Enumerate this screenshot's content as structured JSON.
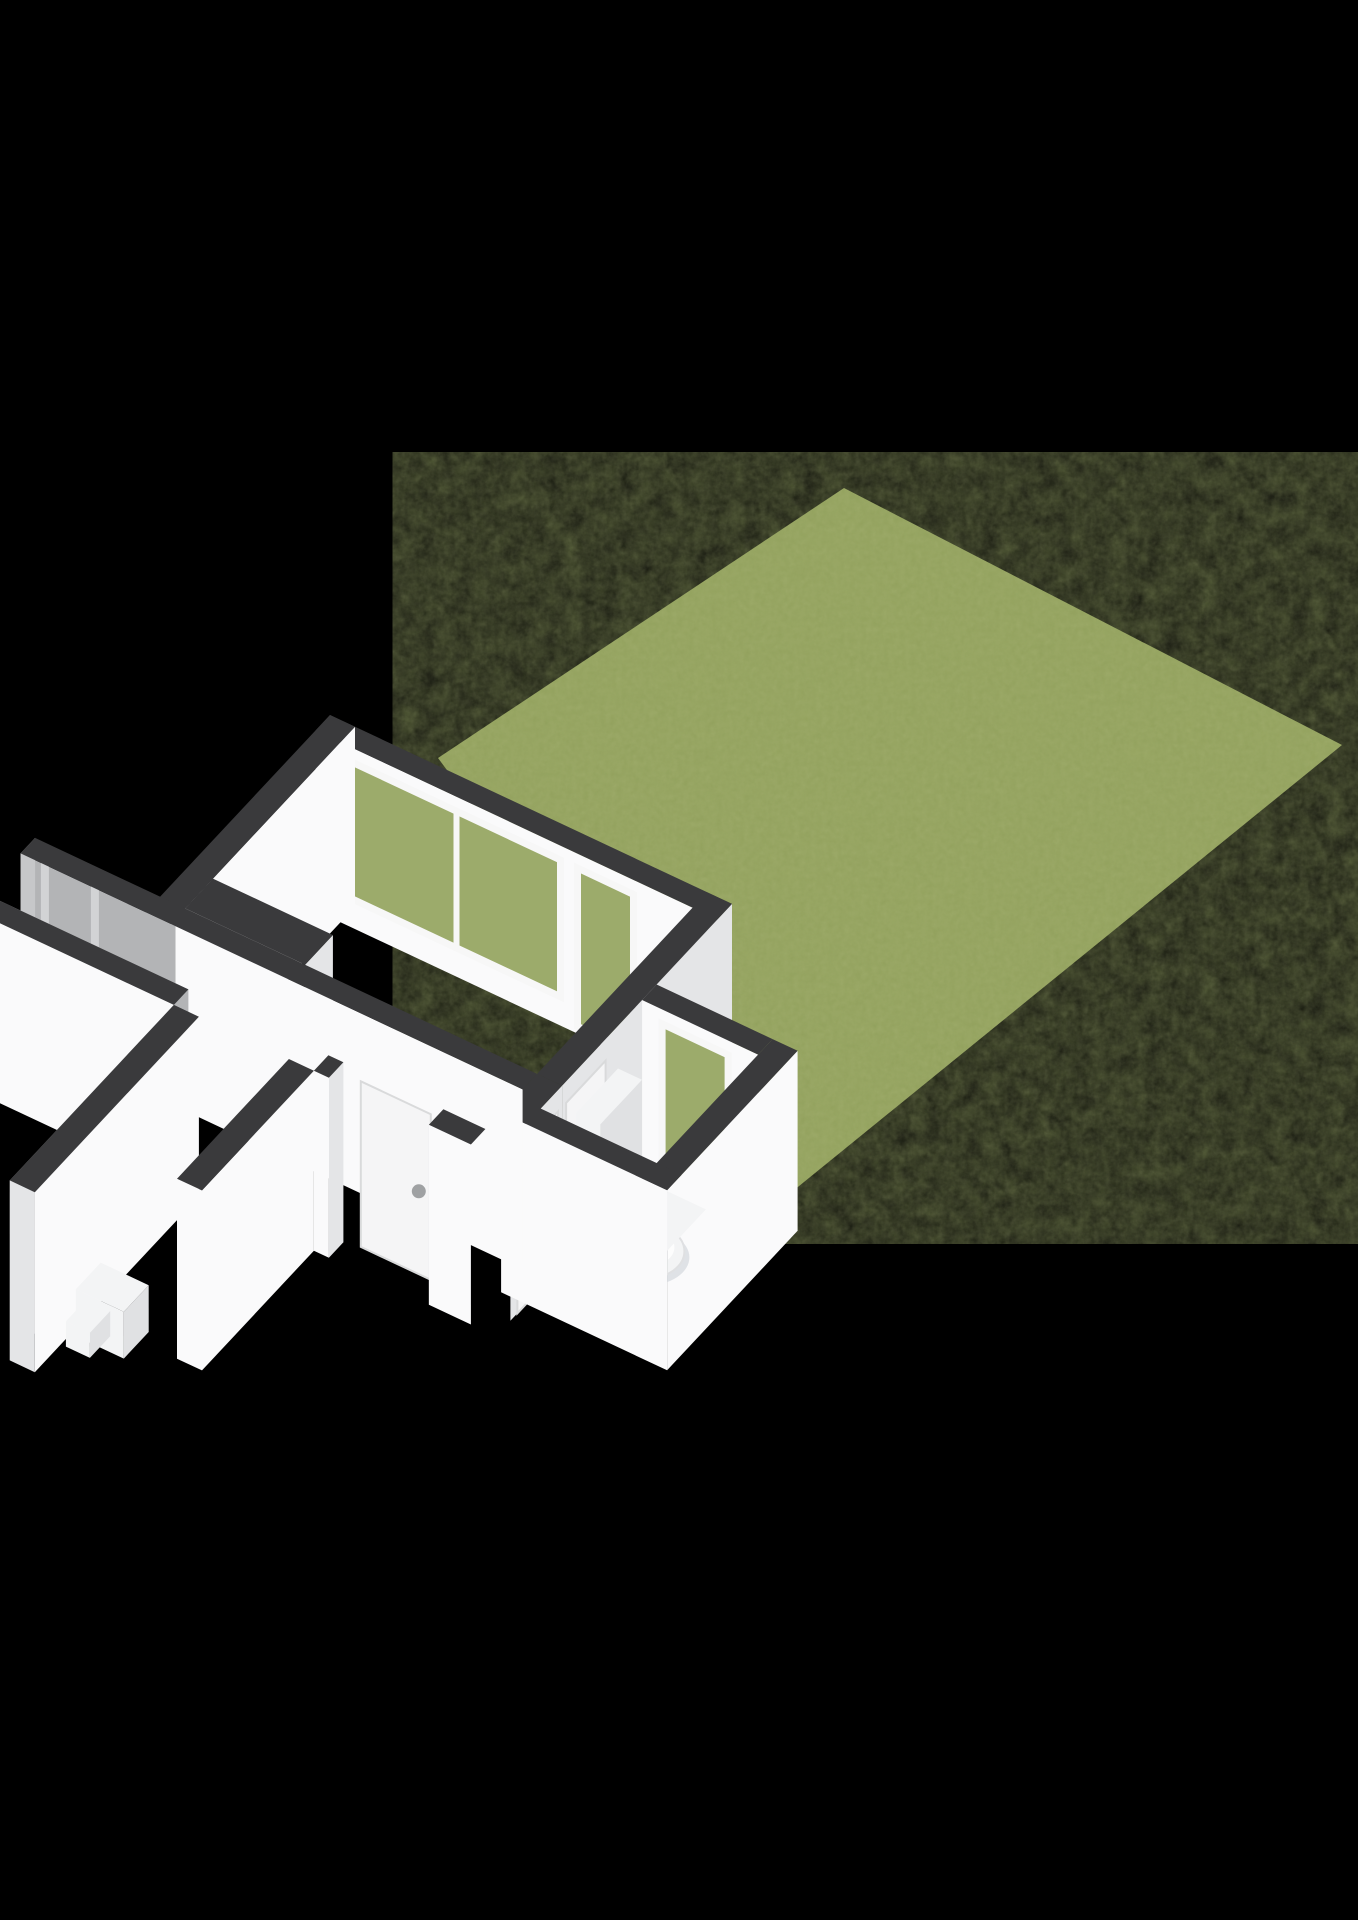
{
  "image": {
    "kind": "3d-floorplan-render",
    "background": "#000000",
    "canvas": {
      "width": 1358,
      "height": 1920
    }
  },
  "projection": {
    "ox": 330,
    "oyCap": 715,
    "ax": 100,
    "ay": 47,
    "bx": -58,
    "by": 62,
    "wallHeight": 180
  },
  "colors": {
    "bg": "#000000",
    "cap": "#3a3a3c",
    "wallBright": "#fafafb",
    "wallLight": "#f1f2f3",
    "wallMid": "#e4e5e7",
    "wallShade": "#d2d3d5",
    "wallGray": "#b3b4b6",
    "wallCut": "#c6c7c9",
    "floorTan": "#d7b07b",
    "floorBath": "#c9d2de",
    "floorHall": "#f2f3f4",
    "grassBase": "#93a25d",
    "glass": "#9cab6b",
    "frame": "#f7f7f7",
    "door": "#f5f5f6",
    "handle": "#9fa1a3",
    "fixture": "#f3f4f5",
    "fixtureShade": "#e0e1e3",
    "toiletShadow": "#c9cdd6"
  },
  "primitives": [
    {
      "t": "screen",
      "n": "garden-lawn",
      "fill": "grassBase",
      "tex": true,
      "pts": [
        [
          844,
          488
        ],
        [
          1342,
          745
        ],
        [
          772,
          1208
        ],
        [
          438,
          758
        ]
      ]
    },
    {
      "t": "face",
      "n": "living-room-garden-wall",
      "side": "sw",
      "v": 0.25,
      "u1": 0,
      "u2": 4.02,
      "fill": "wallBright"
    },
    {
      "t": "glass",
      "n": "living-room-window",
      "v": 0.25,
      "u1": 0.35,
      "u2": 2.45,
      "ft": 0.92,
      "fb": 0.16,
      "mull": [
        1.38
      ]
    },
    {
      "t": "glass",
      "n": "living-room-tall-window",
      "v": 0.25,
      "u1": 2.62,
      "u2": 3.18,
      "ft": 0.92,
      "fb": 0.04,
      "mull": []
    },
    {
      "t": "cap",
      "n": "living-room-garden-wall-cap",
      "u1": 0,
      "v1": 0,
      "u2": 4.02,
      "v2": 0.25
    },
    {
      "t": "face",
      "n": "living-room-west-wall",
      "side": "se",
      "u": 0.25,
      "v1": 0,
      "v2": 3.18,
      "fill": "wallBright"
    },
    {
      "t": "face",
      "n": "living-room-west-wall-end",
      "side": "sw",
      "v": 3.18,
      "u1": 0,
      "u2": 0.25,
      "fill": "wallCut"
    },
    {
      "t": "cap",
      "n": "living-room-west-wall-cap",
      "u1": 0,
      "v1": 0,
      "u2": 0.25,
      "v2": 3.18
    },
    {
      "t": "floor",
      "n": "living-room-floor",
      "fill": "floorTan",
      "pts": [
        [
          0.25,
          0.25
        ],
        [
          3.77,
          0.25
        ],
        [
          3.77,
          2.93
        ],
        [
          1.45,
          2.93
        ],
        [
          1.45,
          2.45
        ],
        [
          0.25,
          2.45
        ]
      ]
    },
    {
      "t": "wall",
      "n": "closet-block",
      "u1": 0.25,
      "v1": 2.45,
      "u2": 1.45,
      "v2": 2.93,
      "faces": [
        {
          "s": "se",
          "fill": "wallMid"
        }
      ]
    },
    {
      "t": "face",
      "n": "living-hall-divider-face",
      "side": "se",
      "u": 4.02,
      "v1": 0,
      "v2": 2.93,
      "fill": "wallMid"
    },
    {
      "t": "cap",
      "n": "living-hall-divider-cap",
      "u1": 3.77,
      "v1": 0,
      "u2": 4.02,
      "v2": 2.93
    },
    {
      "t": "door",
      "n": "living-room-door",
      "u": 4.02,
      "v1": 2.18,
      "v2": 2.86,
      "ft": 0.88,
      "handle": [
        2.74,
        0.46
      ]
    },
    {
      "t": "face",
      "n": "hall-bath-divider-face",
      "side": "se",
      "u": 4.02,
      "v1": 2.93,
      "v2": 3.82,
      "fill": "wallMid"
    },
    {
      "t": "cap",
      "n": "hall-bath-divider-cap",
      "u1": 3.77,
      "v1": 2.93,
      "u2": 4.02,
      "v2": 3.82
    },
    {
      "t": "door",
      "n": "bathroom-door",
      "u": 4.02,
      "v1": 3.0,
      "v2": 3.7,
      "ft": 0.88,
      "handle": [
        3.12,
        0.46
      ]
    },
    {
      "t": "face",
      "n": "bathroom-garden-wall",
      "side": "sw",
      "v": 1.55,
      "u1": 4.02,
      "u2": 5.18,
      "fill": "wallBright"
    },
    {
      "t": "glass",
      "n": "bathroom-window",
      "v": 1.55,
      "u1": 4.22,
      "u2": 4.88,
      "ft": 0.92,
      "fb": 0.05,
      "mull": []
    },
    {
      "t": "cap",
      "n": "bathroom-garden-wall-cap",
      "u1": 4.02,
      "v1": 1.3,
      "u2": 5.18,
      "v2": 1.55
    },
    {
      "t": "face",
      "n": "bathroom-east-wall-outer",
      "side": "se",
      "u": 5.43,
      "v1": 1.3,
      "v2": 3.55,
      "fill": "wallBright"
    },
    {
      "t": "cap",
      "n": "bathroom-east-wall-cap",
      "u1": 5.18,
      "v1": 1.3,
      "u2": 5.43,
      "v2": 3.55
    },
    {
      "t": "floor",
      "n": "bathroom-floor",
      "fill": "floorBath",
      "pts": [
        [
          4.02,
          1.55
        ],
        [
          5.18,
          1.55
        ],
        [
          5.18,
          3.3
        ],
        [
          4.02,
          3.3
        ]
      ]
    },
    {
      "t": "wall",
      "n": "toilet-cistern",
      "u1": 4.04,
      "v1": 2.0,
      "u2": 4.28,
      "v2": 2.72,
      "h": 0.78,
      "cap": "fixture",
      "faces": [
        {
          "s": "se",
          "fill": "fixtureShade"
        },
        {
          "s": "sw",
          "fill": "fixture"
        }
      ]
    },
    {
      "t": "toilet",
      "n": "toilet-bowl",
      "u": 4.52,
      "v": 2.32
    },
    {
      "t": "wall",
      "n": "bathroom-cabinet",
      "u1": 4.8,
      "v1": 2.45,
      "u2": 5.18,
      "v2": 3.2,
      "h": 0.45,
      "cap": "fixture",
      "faces": [
        {
          "s": "w",
          "fill": "fixtureShade"
        },
        {
          "s": "sw",
          "fill": "fixtureShade"
        }
      ]
    },
    {
      "t": "face",
      "n": "bathroom-south-wall",
      "side": "sw",
      "v": 3.55,
      "u1": 3.77,
      "u2": 5.43,
      "fill": "wallBright"
    },
    {
      "t": "cap",
      "n": "bathroom-south-wall-cap",
      "u1": 3.77,
      "v1": 3.3,
      "u2": 5.43,
      "v2": 3.55
    },
    {
      "t": "face",
      "n": "hall-north-wall-west-gray",
      "side": "sw",
      "v": 3.18,
      "u1": -1.25,
      "u2": 0.3,
      "fill": "wallGray"
    },
    {
      "t": "face",
      "n": "door-frame-hint-1",
      "side": "sw",
      "v": 3.175,
      "u1": -1.05,
      "u2": -0.97,
      "fill": "wallShade"
    },
    {
      "t": "face",
      "n": "door-frame-hint-2",
      "side": "sw",
      "v": 3.175,
      "u1": -0.55,
      "u2": -0.47,
      "fill": "wallShade"
    },
    {
      "t": "face",
      "n": "hall-north-wall",
      "side": "sw",
      "v": 3.18,
      "u1": 0.3,
      "u2": 3.77,
      "fill": "wallBright"
    },
    {
      "t": "face",
      "n": "hall-north-wall-cut",
      "side": "w",
      "u": -1.25,
      "v1": 2.93,
      "v2": 3.18,
      "fill": "wallCut"
    },
    {
      "t": "cap",
      "n": "hall-north-wall-cap",
      "u1": -1.25,
      "v1": 2.93,
      "u2": 3.77,
      "v2": 3.18
    },
    {
      "t": "floor",
      "n": "hallway-floor",
      "fill": "floorHall",
      "pts": [
        [
          -1.25,
          3.18
        ],
        [
          3.77,
          3.18
        ],
        [
          3.77,
          3.82
        ],
        [
          -1.25,
          3.82
        ]
      ]
    },
    {
      "t": "panel",
      "n": "front-door",
      "v": 3.78,
      "u1": 2.5,
      "u2": 3.2,
      "ft": 0.92,
      "handle": [
        3.08,
        0.46
      ]
    },
    {
      "t": "face",
      "n": "hall-south-wall-west-inner",
      "side": "sw",
      "v": 3.82,
      "u1": -1.25,
      "u2": 0.8,
      "fill": "wallGray"
    },
    {
      "t": "face",
      "n": "hall-south-wall-west",
      "side": "sw",
      "v": 4.07,
      "u1": -1.25,
      "u2": 0.8,
      "fill": "wallBright"
    },
    {
      "t": "face",
      "n": "hall-south-wall-west-cut",
      "side": "w",
      "u": -1.25,
      "v1": 3.82,
      "v2": 4.07,
      "fill": "wallCut"
    },
    {
      "t": "cap",
      "n": "hall-south-wall-west-cap",
      "u1": -1.25,
      "v1": 3.82,
      "u2": 0.8,
      "v2": 4.07
    },
    {
      "t": "face",
      "n": "doorway-jamb-west",
      "side": "se",
      "u": 2.35,
      "v1": 3.82,
      "v2": 4.07,
      "fill": "wallMid"
    },
    {
      "t": "face",
      "n": "hall-south-wall-mid",
      "side": "sw",
      "v": 4.07,
      "u1": 2.2,
      "u2": 2.35,
      "fill": "wallBright"
    },
    {
      "t": "cap",
      "n": "hall-south-wall-mid-cap",
      "u1": 2.2,
      "v1": 3.82,
      "u2": 2.35,
      "v2": 4.07
    },
    {
      "t": "face",
      "n": "doorway-jamb-east",
      "side": "w",
      "u": 3.35,
      "v1": 3.82,
      "v2": 4.07,
      "fill": "wallShade"
    },
    {
      "t": "face",
      "n": "hall-south-wall-east",
      "side": "sw",
      "v": 4.07,
      "u1": 3.35,
      "u2": 3.77,
      "fill": "wallBright"
    },
    {
      "t": "cap",
      "n": "hall-south-wall-east-cap",
      "u1": 3.35,
      "v1": 3.82,
      "u2": 3.77,
      "v2": 4.07
    },
    {
      "t": "face",
      "n": "corridor-west-wall-outer",
      "side": "w",
      "u": 0.8,
      "v1": 4.07,
      "v2": 6.9,
      "fill": "wallGray"
    },
    {
      "t": "face",
      "n": "corridor-west-wall-inner",
      "side": "se",
      "u": 1.05,
      "v1": 4.07,
      "v2": 6.9,
      "fill": "wallBright"
    },
    {
      "t": "face",
      "n": "corridor-west-wall-end",
      "side": "sw",
      "v": 6.9,
      "u1": 0.8,
      "u2": 1.05,
      "fill": "wallMid"
    },
    {
      "t": "cap",
      "n": "corridor-west-wall-cap",
      "u1": 0.8,
      "v1": 4.07,
      "u2": 1.05,
      "v2": 6.9
    },
    {
      "t": "floor",
      "n": "entrance-corridor-floor",
      "fill": "floorHall",
      "pts": [
        [
          1.05,
          4.07
        ],
        [
          1.95,
          4.07
        ],
        [
          1.95,
          6.9
        ],
        [
          1.05,
          6.9
        ]
      ]
    },
    {
      "t": "wall",
      "n": "corridor-step",
      "u1": 1.1,
      "v1": 5.85,
      "u2": 1.58,
      "v2": 6.28,
      "h": 0.26,
      "cap": "fixture",
      "faces": [
        {
          "s": "se",
          "fill": "fixtureShade"
        },
        {
          "s": "sw",
          "fill": "fixture"
        }
      ]
    },
    {
      "t": "wall",
      "n": "corridor-step-2",
      "u1": 1.1,
      "v1": 6.1,
      "u2": 1.34,
      "v2": 6.45,
      "h": 0.14,
      "cap": "fixture",
      "faces": [
        {
          "s": "se",
          "fill": "fixtureShade"
        },
        {
          "s": "sw",
          "fill": "fixture"
        }
      ]
    },
    {
      "t": "face",
      "n": "corridor-east-wall-outer",
      "side": "se",
      "u": 2.2,
      "v1": 4.07,
      "v2": 6.0,
      "fill": "wallBright"
    },
    {
      "t": "face",
      "n": "corridor-east-wall-end",
      "side": "sw",
      "v": 6.0,
      "u1": 1.95,
      "u2": 2.2,
      "fill": "wallBright"
    },
    {
      "t": "cap",
      "n": "corridor-east-wall-cap",
      "u1": 1.95,
      "v1": 4.07,
      "u2": 2.2,
      "v2": 6.0
    }
  ]
}
